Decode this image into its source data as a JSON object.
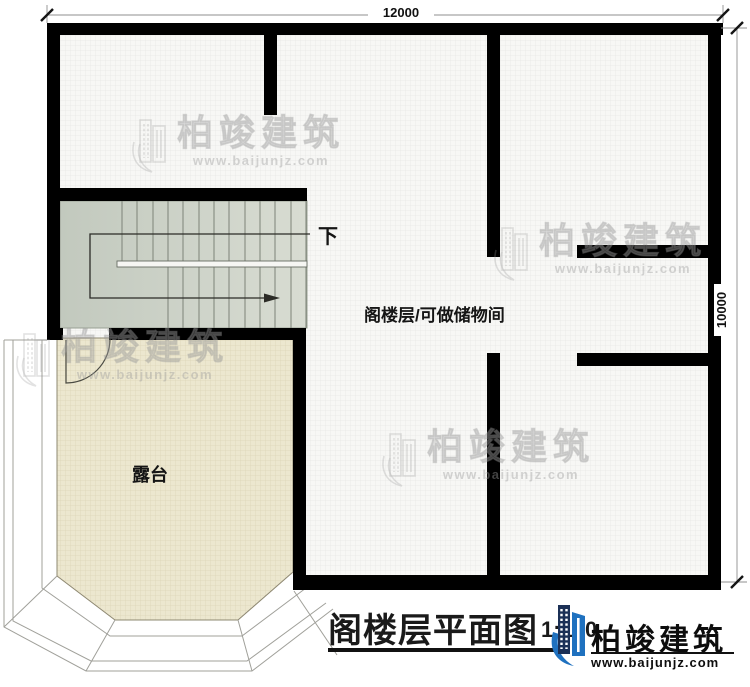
{
  "plan": {
    "dim_top": "12000",
    "dim_right": "10000",
    "down_label": "下",
    "attic_label": "阁楼层/可做储物间",
    "terrace_label": "露台"
  },
  "titleblock": {
    "title": "阁楼层平面图",
    "scale": "1:100"
  },
  "brand": {
    "name": "柏竣建筑",
    "url": "www.baijunjz.com"
  },
  "watermark": {
    "name": "柏竣建筑",
    "url": "www.baijunjz.com"
  },
  "colors": {
    "wall": "#000000",
    "floor": "#f7f7f5",
    "floor_grid": "#e8e8e6",
    "stair_dark": "#c2c9be",
    "stair_light": "#d8dcd2",
    "terrace": "#ece7cf",
    "terrace_grid": "#dcd5b8",
    "outline": "#a0a09a",
    "brand_blue": "#1f71bf",
    "brand_navy": "#1b3056"
  }
}
